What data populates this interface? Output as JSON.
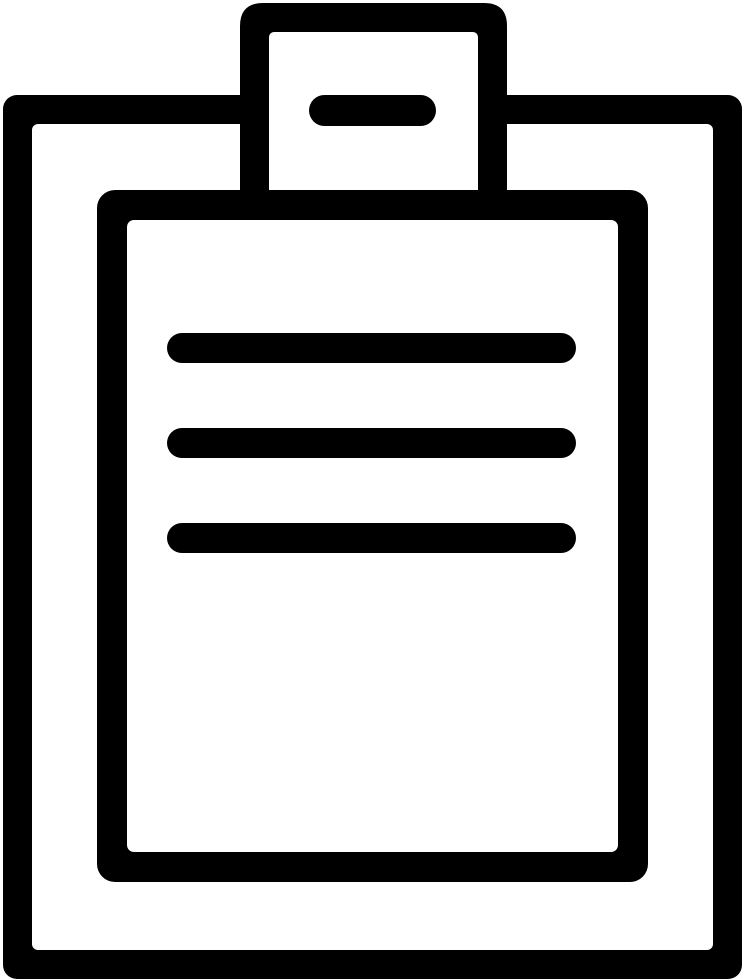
{
  "icon": {
    "name": "clipboard-report-icon",
    "description": "Black line-art icon of a clipboard: outer board frame, top clip tab with a horizontal handle dash, an inner document sheet containing three horizontal text lines",
    "colors": {
      "ink": "#000000",
      "background": "#ffffff"
    },
    "parts": {
      "board": "clipboard board frame",
      "clip_tab": "clip tab",
      "clip_handle": "clip handle dash",
      "sheet": "document sheet",
      "text_lines_count": 3
    }
  }
}
